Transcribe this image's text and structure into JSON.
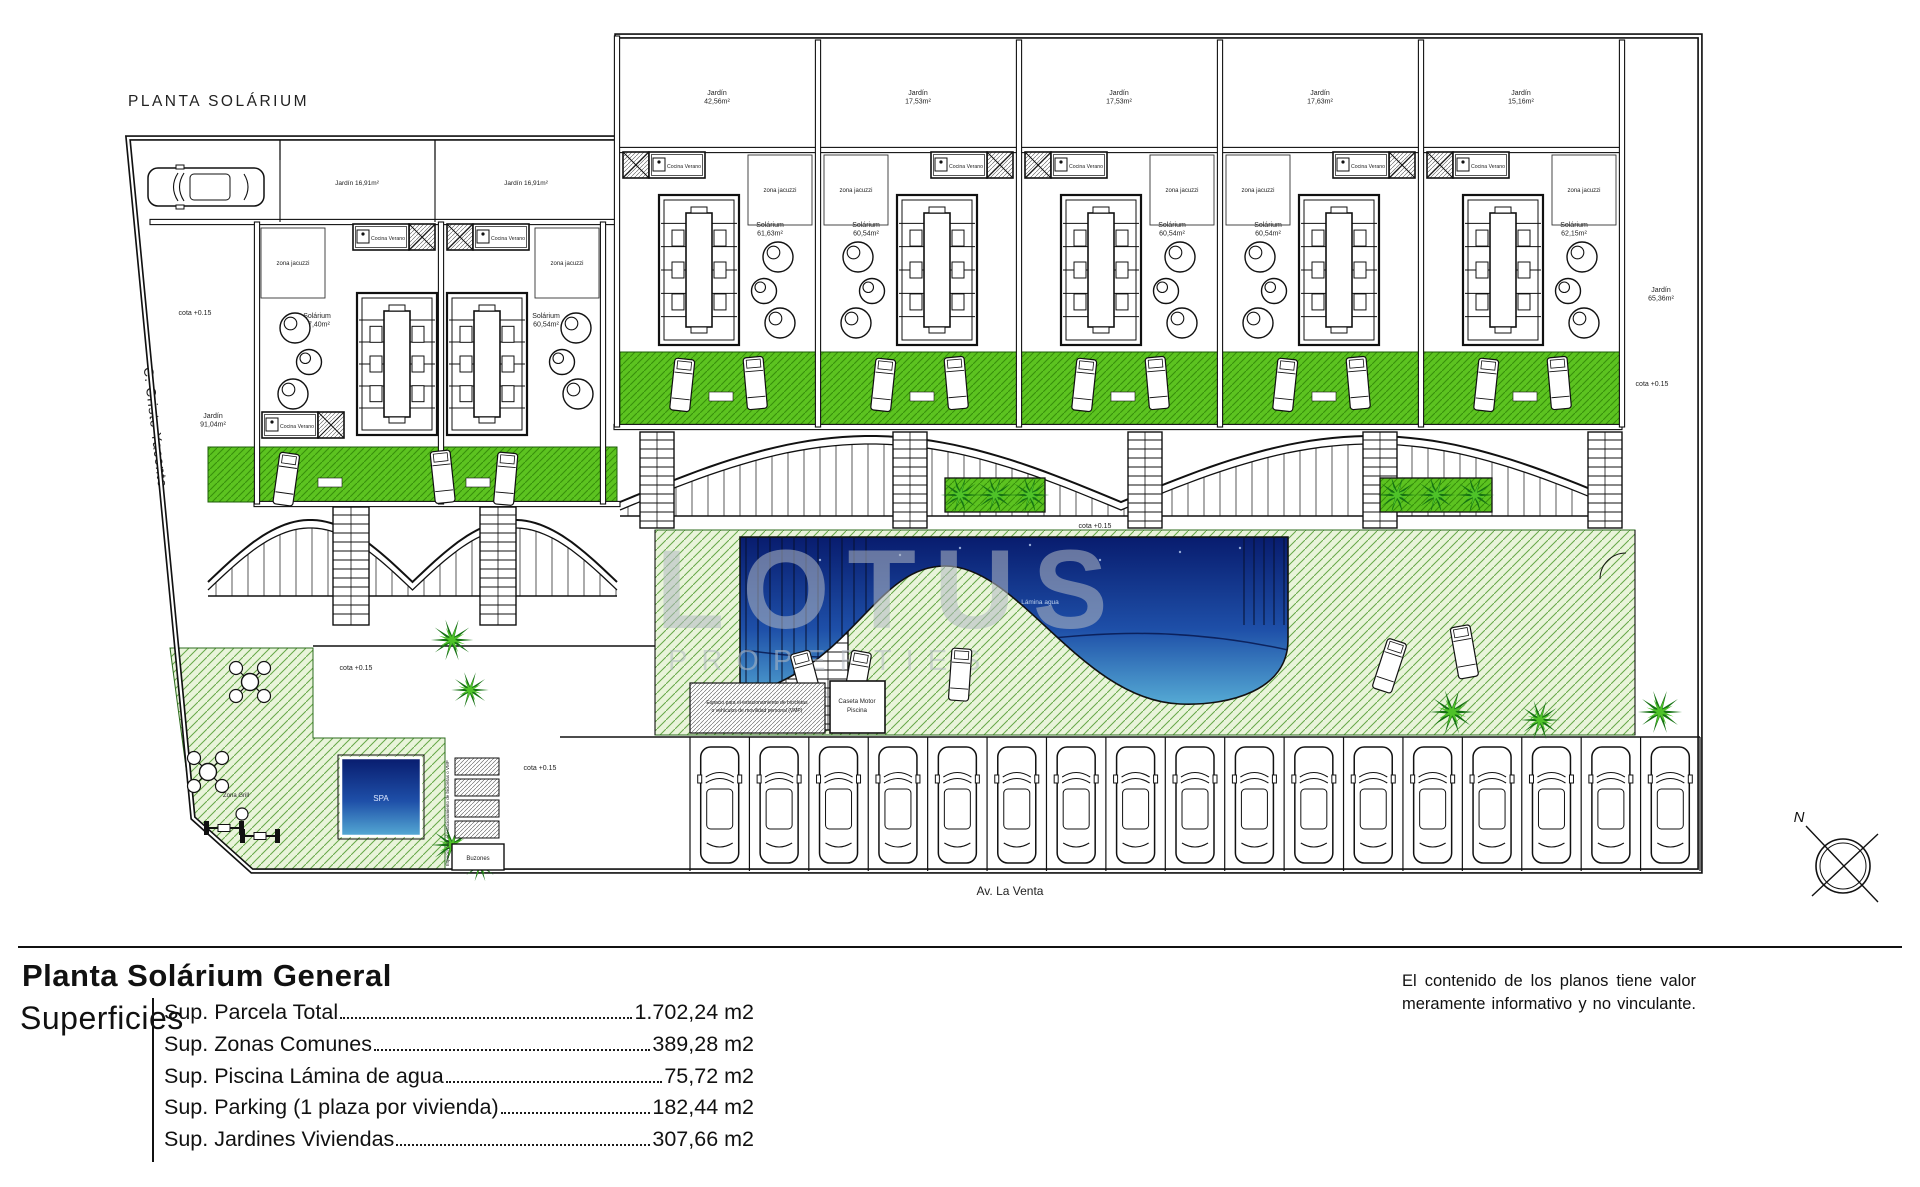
{
  "plan": {
    "title": "PLANTA SOLÁRIUM",
    "streets": {
      "left": "C. Cristo Yacente",
      "bottom": "Av. La Venta"
    },
    "elevation_label": "cota +0.15",
    "compass": "N",
    "watermark": {
      "l1": "LOTUS",
      "l2": "PROPERTIES",
      "l3": "INMOBILIARIA"
    },
    "pool": {
      "label": "Lámina agua",
      "spa": "SPA"
    },
    "caseta": {
      "l1": "Caseta Motor",
      "l2": "Piscina"
    },
    "bike": {
      "l1": "Espacio para el estacionamiento de bicicletas",
      "l2": "o vehículos de movilidad personal (VMP)",
      "side": "Espacio para el estacionamiento de bicicletas o VMP"
    },
    "buzones": "Buzones",
    "zona_grill": "Zona Grill",
    "jacuzzi_label": "zona jacuzzi",
    "cocina_label": "Cocina Verano",
    "strip_garden_label": "Jardín 16,91m²",
    "side_gardens": {
      "left": {
        "name": "Jardín",
        "area": "91,04m²"
      },
      "right": {
        "name": "Jardín",
        "area": "65,36m²"
      }
    },
    "right_units": [
      {
        "garden": "Jardín",
        "garden_area": "42,56m²",
        "solarium": "Solárium",
        "solarium_area": "61,63m²"
      },
      {
        "garden": "Jardín",
        "garden_area": "17,53m²",
        "solarium": "Solárium",
        "solarium_area": "60,54m²"
      },
      {
        "garden": "Jardín",
        "garden_area": "17,53m²",
        "solarium": "Solárium",
        "solarium_area": "60,54m²"
      },
      {
        "garden": "Jardín",
        "garden_area": "17,63m²",
        "solarium": "Solárium",
        "solarium_area": "60,54m²"
      },
      {
        "garden": "Jardín",
        "garden_area": "15,16m²",
        "solarium": "Solárium",
        "solarium_area": "62,15m²"
      }
    ],
    "left_units": [
      {
        "solarium": "Solárium",
        "solarium_area": "47,40m²"
      },
      {
        "solarium": "Solárium",
        "solarium_area": "60,54m²"
      }
    ],
    "parking_count": 17,
    "colors": {
      "line": "#111111",
      "pale_green": "#e9f4da",
      "pale_hatch": "#66a848",
      "vivid_green": "#5cc320",
      "vivid_hatch": "#378f0b",
      "pool_deep": "#081c6e",
      "pool_mid": "#1e4fa8",
      "pool_shallow": "#55aad4",
      "watermark": "#b3bac4"
    }
  },
  "legend": {
    "title": "Planta Solárium General",
    "superficies_label": "Superficies",
    "rows": [
      {
        "label": "Sup. Parcela Total ",
        "value": "1.702,24 m2"
      },
      {
        "label": "Sup. Zonas Comunes ",
        "value": "389,28 m2"
      },
      {
        "label": "Sup. Piscina Lámina de agua",
        "value": "75,72 m2"
      },
      {
        "label": "Sup. Parking (1 plaza por vivienda)",
        "value": "182,44 m2"
      },
      {
        "label": "Sup. Jardines Viviendas",
        "value": "307,66 m2"
      }
    ]
  },
  "disclaimer": {
    "l1": "El contenido de los planos tiene valor",
    "l2": "meramente informativo y no vinculante."
  }
}
